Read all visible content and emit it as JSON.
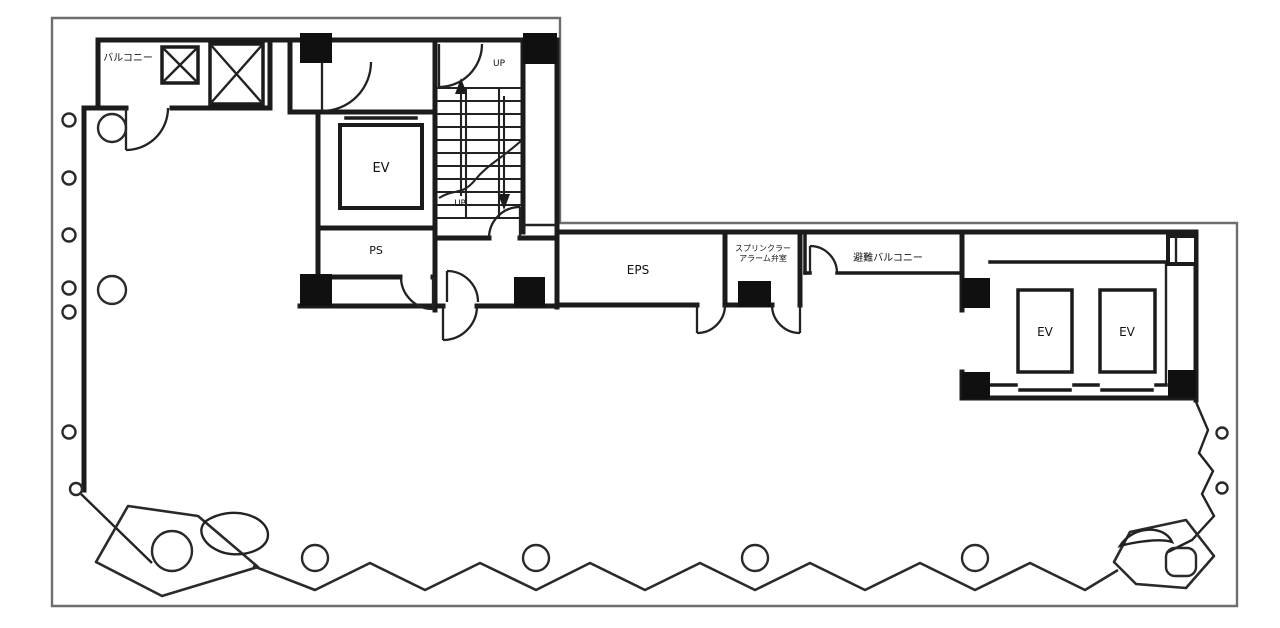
{
  "plan": {
    "title": "building-floor-plan",
    "labels": {
      "balcony": "バルコニー",
      "elevator": "EV",
      "up": "UP",
      "pipe_shaft": "PS",
      "electrical_pipe_shaft": "EPS",
      "sprinkler_line1": "スプリンクラー",
      "sprinkler_line2": "アラーム弁室",
      "evacuation_balcony": "避難バルコニー"
    },
    "colors": {
      "wall": "#1b1b1b",
      "outline": "#6e6e6e",
      "background": "#ffffff"
    }
  }
}
